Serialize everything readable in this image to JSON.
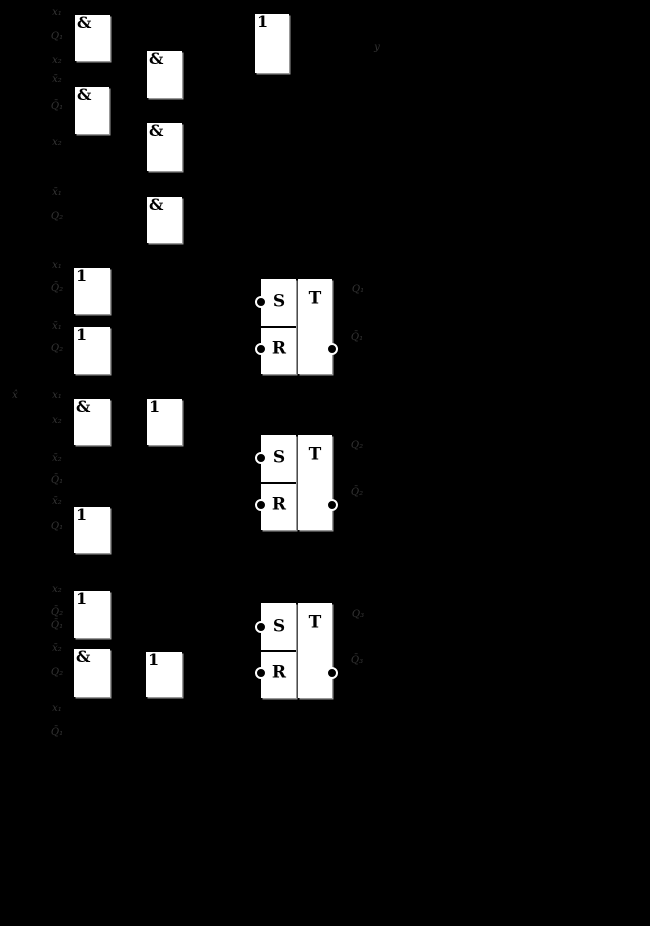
{
  "canvas": {
    "width": 650,
    "height": 926,
    "background_color": "#000000",
    "box_color": "#ffffff",
    "glyph_color": "#000000",
    "label_color": "#343434"
  },
  "flipflop_letters": {
    "s": "S",
    "r": "R",
    "t": "T"
  },
  "gates": [
    {
      "id": "and-gate-1",
      "type": "&",
      "x": 75,
      "y": 15,
      "w": 35,
      "h": 46
    },
    {
      "id": "and-gate-2",
      "type": "&",
      "x": 75,
      "y": 87,
      "w": 34,
      "h": 47
    },
    {
      "id": "and-gate-3",
      "type": "&",
      "x": 147,
      "y": 51,
      "w": 35,
      "h": 47
    },
    {
      "id": "and-gate-4",
      "type": "&",
      "x": 147,
      "y": 123,
      "w": 35,
      "h": 48
    },
    {
      "id": "and-gate-5",
      "type": "&",
      "x": 147,
      "y": 197,
      "w": 35,
      "h": 46
    },
    {
      "id": "or-gate-1",
      "type": "1",
      "x": 255,
      "y": 14,
      "w": 34,
      "h": 59
    },
    {
      "id": "or-gate-2",
      "type": "1",
      "x": 74,
      "y": 268,
      "w": 36,
      "h": 46
    },
    {
      "id": "or-gate-3",
      "type": "1",
      "x": 74,
      "y": 327,
      "w": 36,
      "h": 47
    },
    {
      "id": "and-gate-6",
      "type": "&",
      "x": 74,
      "y": 399,
      "w": 36,
      "h": 46
    },
    {
      "id": "or-gate-4",
      "type": "1",
      "x": 147,
      "y": 399,
      "w": 35,
      "h": 46
    },
    {
      "id": "or-gate-5",
      "type": "1",
      "x": 74,
      "y": 507,
      "w": 36,
      "h": 46
    },
    {
      "id": "or-gate-6",
      "type": "1",
      "x": 74,
      "y": 591,
      "w": 36,
      "h": 47
    },
    {
      "id": "and-gate-7",
      "type": "&",
      "x": 74,
      "y": 649,
      "w": 36,
      "h": 48
    },
    {
      "id": "or-gate-7",
      "type": "1",
      "x": 146,
      "y": 652,
      "w": 36,
      "h": 45
    }
  ],
  "flipflops": [
    {
      "id": "rst-flipflop-1",
      "x": 261,
      "y": 279,
      "w": 71,
      "h": 95,
      "divider_y": 47,
      "s_bubble_y": 23,
      "r_bubble_y": 70,
      "out_bubble_y": 70
    },
    {
      "id": "rst-flipflop-2",
      "x": 261,
      "y": 435,
      "w": 71,
      "h": 95,
      "divider_y": 47,
      "s_bubble_y": 23,
      "r_bubble_y": 70,
      "out_bubble_y": 70
    },
    {
      "id": "rst-flipflop-3",
      "x": 261,
      "y": 603,
      "w": 71,
      "h": 95,
      "divider_y": 47,
      "s_bubble_y": 24,
      "r_bubble_y": 70,
      "out_bubble_y": 70
    }
  ],
  "labels": [
    {
      "id": "input-label-1",
      "text": "x₁",
      "x": 57,
      "y": 13
    },
    {
      "id": "input-label-2",
      "text": "Q₁",
      "x": 57,
      "y": 37
    },
    {
      "id": "input-label-3",
      "text": "x₂",
      "x": 57,
      "y": 61
    },
    {
      "id": "input-label-4",
      "text": "x̄₂",
      "x": 57,
      "y": 80
    },
    {
      "id": "input-label-5",
      "text": "Q̄₁",
      "x": 57,
      "y": 107
    },
    {
      "id": "input-label-6",
      "text": "x₂",
      "x": 57,
      "y": 143
    },
    {
      "id": "input-label-7",
      "text": "x̄₁",
      "x": 57,
      "y": 193
    },
    {
      "id": "input-label-8",
      "text": "Q₂",
      "x": 57,
      "y": 217
    },
    {
      "id": "input-label-9",
      "text": "x₁",
      "x": 57,
      "y": 266
    },
    {
      "id": "input-label-10",
      "text": "Q̄₂",
      "x": 57,
      "y": 289
    },
    {
      "id": "input-label-11",
      "text": "x̄₁",
      "x": 57,
      "y": 327
    },
    {
      "id": "input-label-12",
      "text": "Q₂",
      "x": 57,
      "y": 349
    },
    {
      "id": "input-label-13",
      "text": "x₁",
      "x": 57,
      "y": 396
    },
    {
      "id": "input-label-14",
      "text": "x₂",
      "x": 57,
      "y": 421
    },
    {
      "id": "input-label-15",
      "text": "x̄₂",
      "x": 57,
      "y": 459
    },
    {
      "id": "input-label-16",
      "text": "Q̄₁",
      "x": 57,
      "y": 481
    },
    {
      "id": "input-label-17",
      "text": "x̄₂",
      "x": 57,
      "y": 502
    },
    {
      "id": "input-label-18",
      "text": "Q₁",
      "x": 57,
      "y": 527
    },
    {
      "id": "input-label-19",
      "text": "x₂",
      "x": 57,
      "y": 590
    },
    {
      "id": "input-label-20",
      "text": "Q̄₂",
      "x": 57,
      "y": 613
    },
    {
      "id": "input-label-21",
      "text": "Q̄₁",
      "x": 57,
      "y": 626
    },
    {
      "id": "input-label-22",
      "text": "x̄₂",
      "x": 57,
      "y": 649
    },
    {
      "id": "input-label-23",
      "text": "Q₂",
      "x": 57,
      "y": 673
    },
    {
      "id": "input-label-24",
      "text": "x₁",
      "x": 57,
      "y": 709
    },
    {
      "id": "input-label-25",
      "text": "Q̄₁",
      "x": 57,
      "y": 733
    },
    {
      "id": "x-hat-label",
      "text": "x̂",
      "x": 15,
      "y": 396
    },
    {
      "id": "output-y-label",
      "text": "y",
      "x": 377,
      "y": 48
    },
    {
      "id": "q1-label",
      "text": "Q₁",
      "x": 358,
      "y": 290
    },
    {
      "id": "q1-bar-label",
      "text": "Q̄₁",
      "x": 357,
      "y": 338
    },
    {
      "id": "q2-label",
      "text": "Q₂",
      "x": 357,
      "y": 446
    },
    {
      "id": "q2-bar-label",
      "text": "Q̄₂",
      "x": 357,
      "y": 493
    },
    {
      "id": "q3-label",
      "text": "Q₃",
      "x": 358,
      "y": 615
    },
    {
      "id": "q3-bar-label",
      "text": "Q̄₃",
      "x": 357,
      "y": 661
    }
  ]
}
